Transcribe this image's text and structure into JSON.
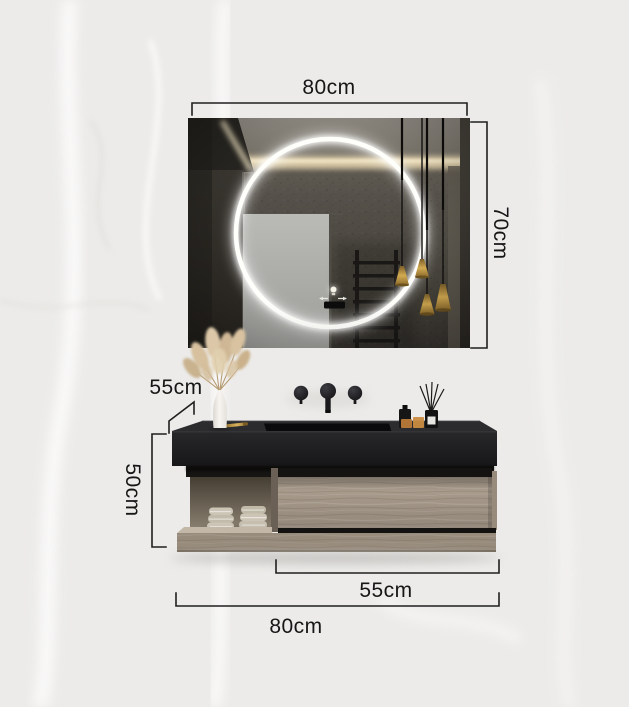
{
  "dimensions": {
    "mirror_width": "80cm",
    "mirror_height": "70cm",
    "counter_depth": "55cm",
    "cabinet_height": "50cm",
    "drawer_width": "55cm",
    "overall_width": "80cm"
  },
  "colors": {
    "background": "#ecebe9",
    "label-text": "#161616",
    "dimension-line": "#1f1f1f",
    "countertop": "#1e1e21",
    "wood": "#a89b8c",
    "wood-dark": "#8b7f70",
    "brass": "#c9a24b",
    "led-ring": "#ffffff",
    "towel": "#ccc5b6",
    "door": "#b5b6b2"
  }
}
